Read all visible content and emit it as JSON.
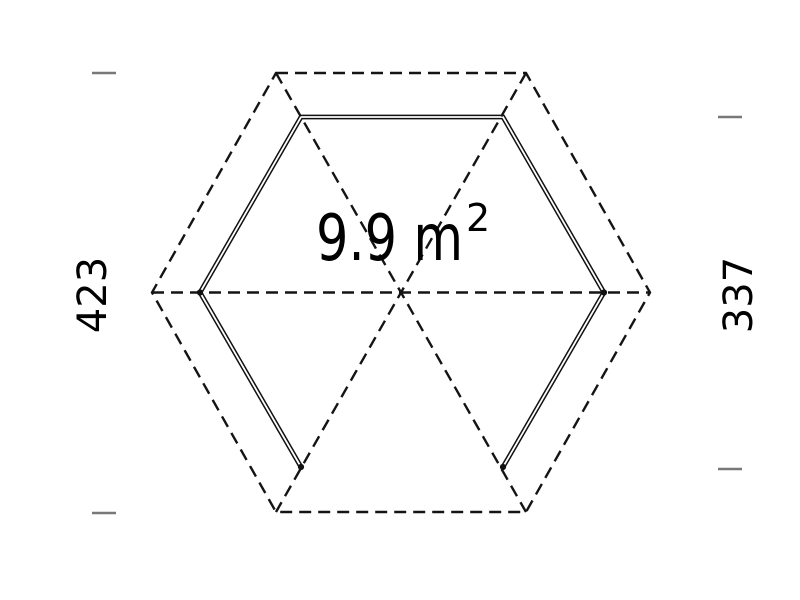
{
  "plan": {
    "area_value": "9.9 m",
    "area_exponent": "2",
    "area_display": "9.9 m²",
    "dimension_left": "423",
    "dimension_right": "337"
  },
  "colors": {
    "outline": "#141414",
    "wall": "#111111",
    "tick": "#787878",
    "text": "#000000",
    "background": "#ffffff"
  }
}
